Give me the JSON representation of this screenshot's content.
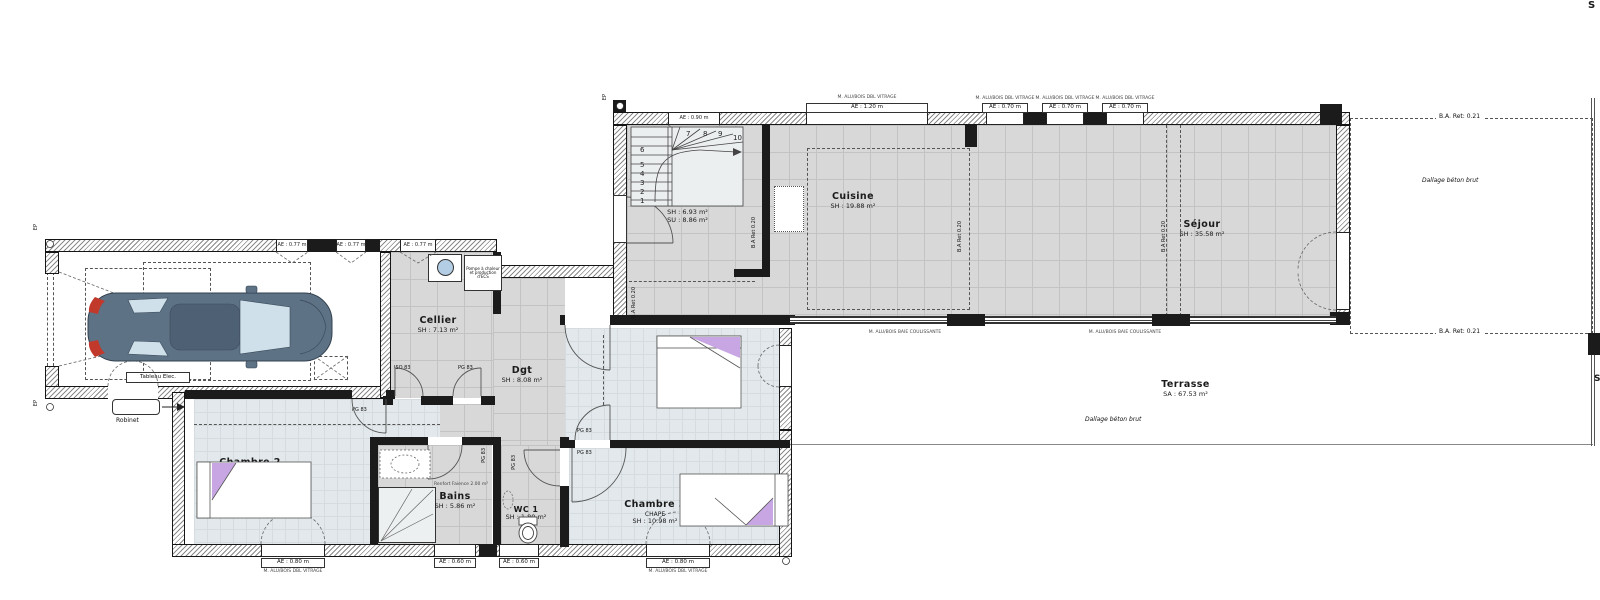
{
  "rooms": {
    "garage": {
      "name": "Garage",
      "area": "SA : 22.05 m²"
    },
    "cellier": {
      "name": "Cellier",
      "area": "SH : 7.13 m²"
    },
    "entree": {
      "name": "Entrée",
      "area_sh": "SH : 6.93 m²",
      "area_su": "SU : 8.86 m²"
    },
    "cuisine": {
      "name": "Cuisine",
      "area": "SH : 19.88 m²"
    },
    "sejour": {
      "name": "Séjour",
      "area": "SH : 35.58 m²"
    },
    "dgt": {
      "name": "Dgt",
      "area": "SH : 8.08 m²"
    },
    "chambre2": {
      "name": "Chambre 2",
      "sub": "CHAPE",
      "area": "SH : 12.56 m²"
    },
    "chambre3": {
      "name": "Chambre 3",
      "sub": "CHAPE",
      "area": "SH : 10.98 m²"
    },
    "chambre4": {
      "name": "Chambre 4",
      "sub": "CHAPE",
      "area": "SH : 10.98 m²"
    },
    "bains": {
      "name": "Bains",
      "area": "SH : 5.86 m²"
    },
    "wc1": {
      "name": "WC 1",
      "area": "SH : 1.80 m²"
    },
    "terrasse": {
      "name": "Terrasse",
      "area": "SA : 67.53 m²"
    }
  },
  "annotations": {
    "dallage": "Dallage béton brut",
    "ba_ret_021": "B.A. Ret: 0.21",
    "ba_ret_020": "B.A Ret 0.20",
    "tableau_elec": "Tableau Elec.",
    "robinet": "Robinet",
    "pac_note": "Pompe à chaleur et production d'ECS",
    "renfort": "Renfort Faience 2.00 m²",
    "ep": "EP",
    "s_marker": "S"
  },
  "doors": {
    "iso83": "ISO 83",
    "pg83": "PG 83"
  },
  "windows": {
    "ae_120": "AE : 1.20 m",
    "ae_090": "AE : 0.90 m",
    "ae_070": "AE : 0.70 m",
    "ae_077": "AE : 0.77 m",
    "ae_080": "AE : 0.80 m",
    "ae_060": "AE : 0.60 m",
    "micro_top": "M. ALU/BOIS DBL VITRAGE",
    "micro_baie": "M. ALU/BOIS BAIE COULISSANTE"
  },
  "stairs": {
    "steps": [
      "1",
      "2",
      "3",
      "4",
      "5",
      "6",
      "7",
      "8",
      "9",
      "10"
    ]
  },
  "colors": {
    "tile_floor": "#d8d8d8",
    "chape_floor": "#e2e8eb",
    "accent_purple": "#c7a6e3",
    "car_body": "#5d7285",
    "tail_red": "#c0392b"
  }
}
